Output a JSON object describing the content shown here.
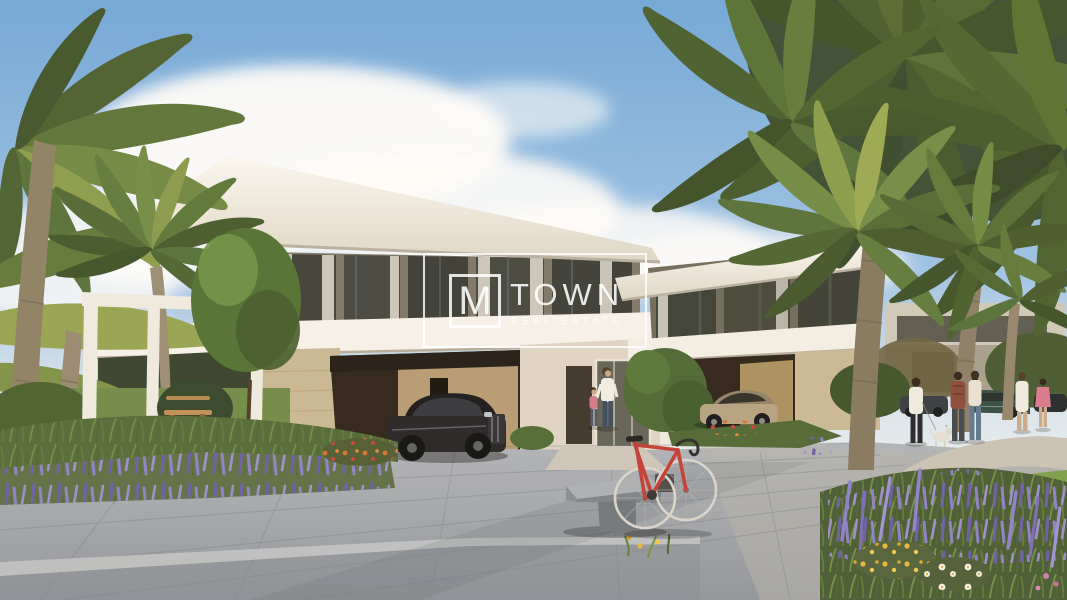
{
  "meta": {
    "kind": "architectural-render-photograph",
    "width_px": 1067,
    "height_px": 600
  },
  "watermark": {
    "monogram": "M",
    "brand": "TOWN",
    "tagline": "REAL ESTATE",
    "color": "#ffffff",
    "opacity": 0.85
  },
  "scene": {
    "description": "Daylight render of modern flat-roofed villas lined with date palms; landscaped beds of lavender, marigolds and daisies; a red road bicycle leaning on a concrete bench on a stone-paved plaza; luxury cars parked in carports; residents strolling on a curved path",
    "elements": [
      "blue-sky",
      "cumulus-clouds",
      "date-palm-trees",
      "modern-white-villas",
      "white-pergola-frames",
      "stone-clad-wall",
      "black-luxury-sedan",
      "champagne-luxury-coupe",
      "background-parked-cars",
      "woman-with-child",
      "group-of-residents",
      "small-white-dog",
      "red-road-bicycle",
      "concrete-bench",
      "wooden-garden-bench",
      "lavender-flower-bed",
      "marigold-flowers",
      "white-daisies",
      "stone-paved-plaza",
      "light-walking-path",
      "green-lawn"
    ],
    "palette": {
      "sky_top": "#6fa7db",
      "sky_horizon": "#eef3f5",
      "cloud_white": "#ffffff",
      "villa_white": "#f4f1e8",
      "stone_beige": "#c8b795",
      "carport_shadow": "#2b2119",
      "palm_dark_green": "#41542e",
      "palm_light_green": "#9aa851",
      "lavender_purple": "#8f81d0",
      "marigold_yellow": "#e8b63c",
      "daisy_white": "#f5f4ee",
      "bike_red": "#c23b34",
      "pavement_gray": "#a3a8ae",
      "path_light": "#c9c3b8",
      "sedan_black": "#1e1d20",
      "coupe_champagne": "#b4a283"
    }
  }
}
